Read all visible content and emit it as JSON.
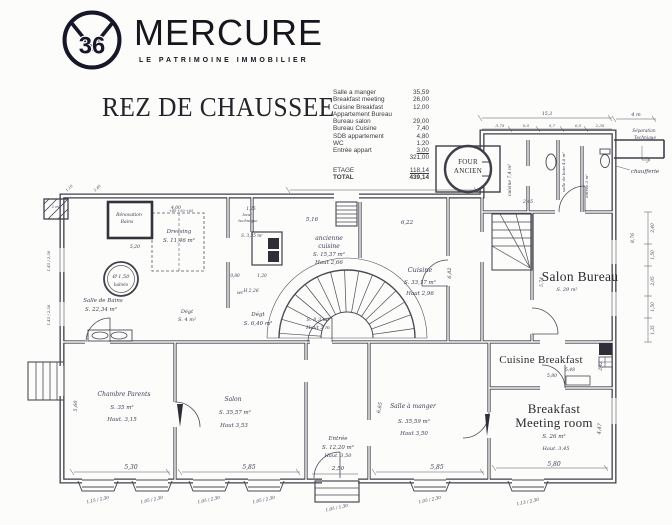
{
  "header": {
    "logo_number": "36",
    "brand": "MERCURE",
    "tagline": "LE PATRIMOINE IMMOBILIER"
  },
  "title": "REZ DE CHAUSSEE",
  "area_table": {
    "rows": [
      {
        "l": "Salle a manger",
        "v": "35,59"
      },
      {
        "l": "Breakfast meeting",
        "v": "26,00"
      },
      {
        "l": "Cuisine Breakfast",
        "v": "12,00"
      },
      {
        "l": "Appartement Bureau",
        "v": ""
      },
      {
        "l": "Bureau salon",
        "v": "29,00"
      },
      {
        "l": "Bureau Cuisine",
        "v": "7,40"
      },
      {
        "l": "SDB appartement",
        "v": "4,80"
      },
      {
        "l": "WC",
        "v": "1,20"
      },
      {
        "l": "Entrée appart",
        "v": "3,00",
        "u": true
      },
      {
        "l": "",
        "v": "321,00"
      }
    ],
    "etage": {
      "label": "ETAGE",
      "value": "118,14"
    },
    "total": {
      "label": "TOTAL",
      "value": "439,14"
    }
  },
  "plan": {
    "labels": [
      {
        "t": "Salon Bureau",
        "x": 580,
        "y": 281,
        "s": 13.5,
        "f": "t"
      },
      {
        "t": "Cuisine Breakfast",
        "x": 541,
        "y": 363,
        "s": 11,
        "f": "t"
      },
      {
        "t": "Breakfast",
        "x": 554,
        "y": 413,
        "s": 13,
        "f": "t"
      },
      {
        "t": "Meeting room",
        "x": 554,
        "y": 427,
        "s": 13,
        "f": "t"
      },
      {
        "t": "FOUR",
        "x": 468,
        "y": 164,
        "s": 7,
        "f": "t"
      },
      {
        "t": "ANCIEN",
        "x": 468,
        "y": 173,
        "s": 7,
        "f": "t"
      },
      {
        "t": "ancienne",
        "x": 329,
        "y": 240,
        "s": 6
      },
      {
        "t": "cuisine",
        "x": 329,
        "y": 248,
        "s": 6
      },
      {
        "t": "S. 15,37 m²",
        "x": 329,
        "y": 256,
        "s": 5.5
      },
      {
        "t": "Haut 2,66",
        "x": 329,
        "y": 264,
        "s": 5.5
      },
      {
        "t": "Cuisine",
        "x": 420,
        "y": 272,
        "s": 6.5
      },
      {
        "t": "S. 33,17 m²",
        "x": 420,
        "y": 284,
        "s": 5.5
      },
      {
        "t": "Haut 2,96",
        "x": 420,
        "y": 295,
        "s": 5.5
      },
      {
        "t": "Salle de Bains",
        "x": 103,
        "y": 302,
        "s": 5.5
      },
      {
        "t": "S. 22,34 m²",
        "x": 101,
        "y": 311,
        "s": 5.5
      },
      {
        "t": "Dressing",
        "x": 179,
        "y": 233,
        "s": 5.5
      },
      {
        "t": "S. 11,46 m²",
        "x": 179,
        "y": 242,
        "s": 5.5
      },
      {
        "t": "Dégt",
        "x": 187,
        "y": 313,
        "s": 5
      },
      {
        "t": "S. 4 m²",
        "x": 187,
        "y": 321,
        "s": 5
      },
      {
        "t": "Dégt",
        "x": 258,
        "y": 316,
        "s": 5.5
      },
      {
        "t": "S. 6,40 m²",
        "x": 258,
        "y": 325,
        "s": 5.5
      },
      {
        "t": "S. 8,3 m²",
        "x": 318,
        "y": 321,
        "s": 5
      },
      {
        "t": "Haut 2 m",
        "x": 318,
        "y": 329,
        "s": 5
      },
      {
        "t": "Entrée",
        "x": 338,
        "y": 440,
        "s": 5.5
      },
      {
        "t": "S. 12,20 m²",
        "x": 338,
        "y": 449,
        "s": 5.5
      },
      {
        "t": "Haut. 3,50",
        "x": 338,
        "y": 457,
        "s": 5
      },
      {
        "t": "Chambre Parents",
        "x": 124,
        "y": 396,
        "s": 6
      },
      {
        "t": "S. 35 m²",
        "x": 122,
        "y": 409,
        "s": 5.5
      },
      {
        "t": "Haut. 3,15",
        "x": 122,
        "y": 421,
        "s": 5.5
      },
      {
        "t": "Salon",
        "x": 233,
        "y": 401,
        "s": 6
      },
      {
        "t": "S. 35,57 m²",
        "x": 235,
        "y": 414,
        "s": 5.5
      },
      {
        "t": "Haut 3,53",
        "x": 234,
        "y": 427,
        "s": 5.5
      },
      {
        "t": "Salle à manger",
        "x": 413,
        "y": 408,
        "s": 6
      },
      {
        "t": "S. 35,59 m²",
        "x": 414,
        "y": 423,
        "s": 5.5
      },
      {
        "t": "Haut 3,50",
        "x": 414,
        "y": 435,
        "s": 5.5
      },
      {
        "t": "S. 26 m²",
        "x": 554,
        "y": 438,
        "s": 5.5
      },
      {
        "t": "Haut. 3,45",
        "x": 556,
        "y": 450,
        "s": 5
      },
      {
        "t": "Ø 1,50",
        "x": 121,
        "y": 278,
        "s": 5
      },
      {
        "t": "balnéo",
        "x": 121,
        "y": 286,
        "s": 4.2
      },
      {
        "t": "Rénovation",
        "x": 129,
        "y": 216,
        "s": 4.5
      },
      {
        "t": "Bains",
        "x": 127,
        "y": 223,
        "s": 4.5
      },
      {
        "t": "2 m²",
        "x": 56,
        "y": 208,
        "s": 3.8
      },
      {
        "t": "local",
        "x": 247,
        "y": 216,
        "s": 3.8
      },
      {
        "t": "technique",
        "x": 248,
        "y": 222,
        "s": 3.8
      },
      {
        "t": "S. 3,35 m²",
        "x": 252,
        "y": 237,
        "s": 4.2
      },
      {
        "t": "H 2,26",
        "x": 251,
        "y": 292,
        "s": 4.5
      },
      {
        "t": "0,80",
        "x": 235,
        "y": 277,
        "s": 4.2
      },
      {
        "t": "1,20",
        "x": 262,
        "y": 277,
        "s": 4.2
      },
      {
        "t": "wc",
        "x": 240,
        "y": 294,
        "s": 4.5
      },
      {
        "t": "1,25",
        "x": 251,
        "y": 210,
        "s": 4.2
      },
      {
        "t": "+45  +50  +65",
        "x": 181,
        "y": 212,
        "s": 3.5
      },
      {
        "t": "cuisine 7,4 m²",
        "x": 511,
        "y": 180,
        "s": 4.5,
        "r": -90
      },
      {
        "t": "salle de bain 4,8 m²",
        "x": 565,
        "y": 172,
        "s": 4,
        "r": -90
      },
      {
        "t": "entrée 3 m²",
        "x": 588,
        "y": 186,
        "s": 4,
        "r": -90
      },
      {
        "t": "5,74",
        "x": 543,
        "y": 282,
        "s": 4.5,
        "r": -90
      },
      {
        "t": "S. 29 m²",
        "x": 567,
        "y": 291,
        "s": 5
      },
      {
        "t": "chaufferie",
        "x": 645,
        "y": 173,
        "s": 5.5
      },
      {
        "t": "Séparation",
        "x": 644,
        "y": 132,
        "s": 4.2
      },
      {
        "t": "Technique",
        "x": 645,
        "y": 139,
        "s": 4.2
      },
      {
        "t": "4 m",
        "x": 636,
        "y": 116,
        "s": 5
      },
      {
        "t": "8,76",
        "x": 634,
        "y": 238,
        "s": 4.5,
        "r": -90
      },
      {
        "t": "2,40",
        "x": 654,
        "y": 228,
        "s": 4.2,
        "r": -90
      },
      {
        "t": "1,50",
        "x": 654,
        "y": 255,
        "s": 4.2,
        "r": -90
      },
      {
        "t": "2,05",
        "x": 654,
        "y": 281,
        "s": 4.2,
        "r": -90
      },
      {
        "t": "1,50",
        "x": 654,
        "y": 307,
        "s": 4.2,
        "r": -90
      },
      {
        "t": "1,35",
        "x": 654,
        "y": 330,
        "s": 4.2,
        "r": -90
      },
      {
        "t": "15,3",
        "x": 547,
        "y": 115,
        "s": 4.5
      },
      {
        "t": "3,75",
        "x": 500,
        "y": 127,
        "s": 4
      },
      {
        "t": "0,5",
        "x": 526,
        "y": 127,
        "s": 4
      },
      {
        "t": "5,7",
        "x": 552,
        "y": 127,
        "s": 4
      },
      {
        "t": "0,5",
        "x": 578,
        "y": 127,
        "s": 4
      },
      {
        "t": "2,35",
        "x": 600,
        "y": 127,
        "s": 4
      },
      {
        "t": "5,16",
        "x": 312,
        "y": 221,
        "s": 5.5
      },
      {
        "t": "6,22",
        "x": 407,
        "y": 224,
        "s": 5.5
      },
      {
        "t": "4,00",
        "x": 176,
        "y": 209,
        "s": 4.5
      },
      {
        "t": "5,20",
        "x": 135,
        "y": 248,
        "s": 4.5
      },
      {
        "t": "2,45",
        "x": 528,
        "y": 203,
        "s": 4.5
      },
      {
        "t": "6,82",
        "x": 451,
        "y": 273,
        "s": 5,
        "r": -90
      },
      {
        "t": "6,65",
        "x": 381,
        "y": 408,
        "s": 5,
        "r": -78
      },
      {
        "t": "5,60",
        "x": 77,
        "y": 406,
        "s": 5,
        "r": -90
      },
      {
        "t": "4,47",
        "x": 601,
        "y": 429,
        "s": 5,
        "r": -85
      },
      {
        "t": "5,48",
        "x": 570,
        "y": 371,
        "s": 4.5
      },
      {
        "t": "5,80",
        "x": 552,
        "y": 377,
        "s": 4.5
      },
      {
        "t": "2,42",
        "x": 602,
        "y": 366,
        "s": 4.2,
        "r": -90
      },
      {
        "t": "5,30",
        "x": 131,
        "y": 469,
        "s": 6
      },
      {
        "t": "5,85",
        "x": 249,
        "y": 469,
        "s": 6
      },
      {
        "t": "5,85",
        "x": 437,
        "y": 469,
        "s": 6
      },
      {
        "t": "5,80",
        "x": 554,
        "y": 466,
        "s": 6
      },
      {
        "t": "2,50",
        "x": 338,
        "y": 470,
        "s": 5.5
      },
      {
        "t": "1,15 / 2,30",
        "x": 98,
        "y": 501,
        "s": 4.2,
        "r": -12
      },
      {
        "t": "1,05 / 2,30",
        "x": 152,
        "y": 501,
        "s": 4.2,
        "r": -12
      },
      {
        "t": "1,05 / 2,30",
        "x": 209,
        "y": 501,
        "s": 4.2,
        "r": -12
      },
      {
        "t": "1,05 / 2,30",
        "x": 264,
        "y": 501,
        "s": 4.2,
        "r": -12
      },
      {
        "t": "1,05 / 1,30",
        "x": 337,
        "y": 509,
        "s": 4.2,
        "r": -12
      },
      {
        "t": "1,05 / 2,30",
        "x": 430,
        "y": 501,
        "s": 4.2,
        "r": -12
      },
      {
        "t": "1,13 / 2,30",
        "x": 528,
        "y": 503,
        "s": 4.2,
        "r": -12
      },
      {
        "t": "1,45 / 2,50",
        "x": 50,
        "y": 261,
        "s": 3.8,
        "r": -90
      },
      {
        "t": "1,45 / 2,50",
        "x": 50,
        "y": 315,
        "s": 3.8,
        "r": -90
      },
      {
        "t": "1,10",
        "x": 70,
        "y": 189,
        "s": 3.6,
        "r": -40
      },
      {
        "t": "2,40",
        "x": 98,
        "y": 189,
        "s": 3.6,
        "r": -40
      }
    ]
  }
}
